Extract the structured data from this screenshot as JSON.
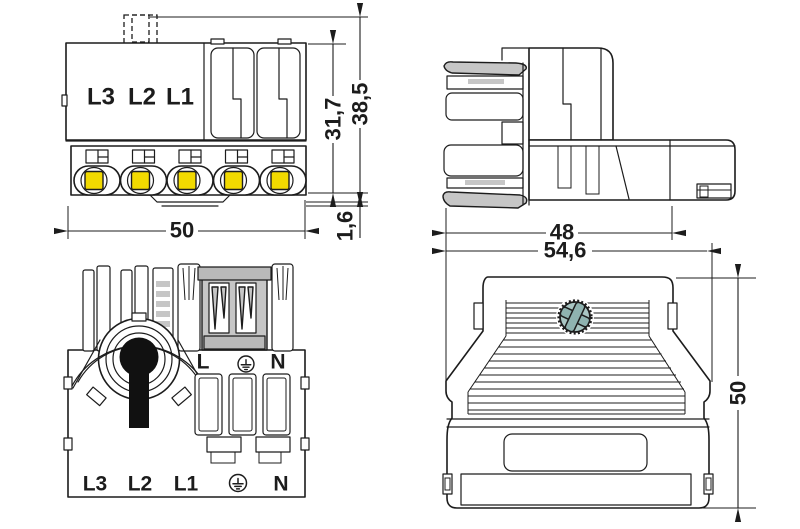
{
  "drawing": {
    "type": "connector-technical-drawing",
    "views": {
      "front": {
        "phase_labels": [
          "L3",
          "L2",
          "L1"
        ],
        "dims": {
          "width": "50",
          "height_inner": "31,7",
          "height_outer": "38,5",
          "rail_lip": "1,6"
        },
        "terminal_count": 5
      },
      "side": {
        "dims": {
          "depth": "48"
        }
      },
      "mating_face": {
        "top_labels": {
          "live": "L",
          "neutral": "N"
        },
        "bottom_labels": [
          "L3",
          "L2",
          "L1",
          "N"
        ]
      },
      "housing_rear": {
        "dims": {
          "width": "54,6",
          "height": "50"
        }
      }
    },
    "colors": {
      "line": "#1c1c1c",
      "terminal_yellow": "#f2da00",
      "shade_gray": "#c6c6c6",
      "screw_teal": "#a9c6c3",
      "background": "#ffffff"
    }
  }
}
